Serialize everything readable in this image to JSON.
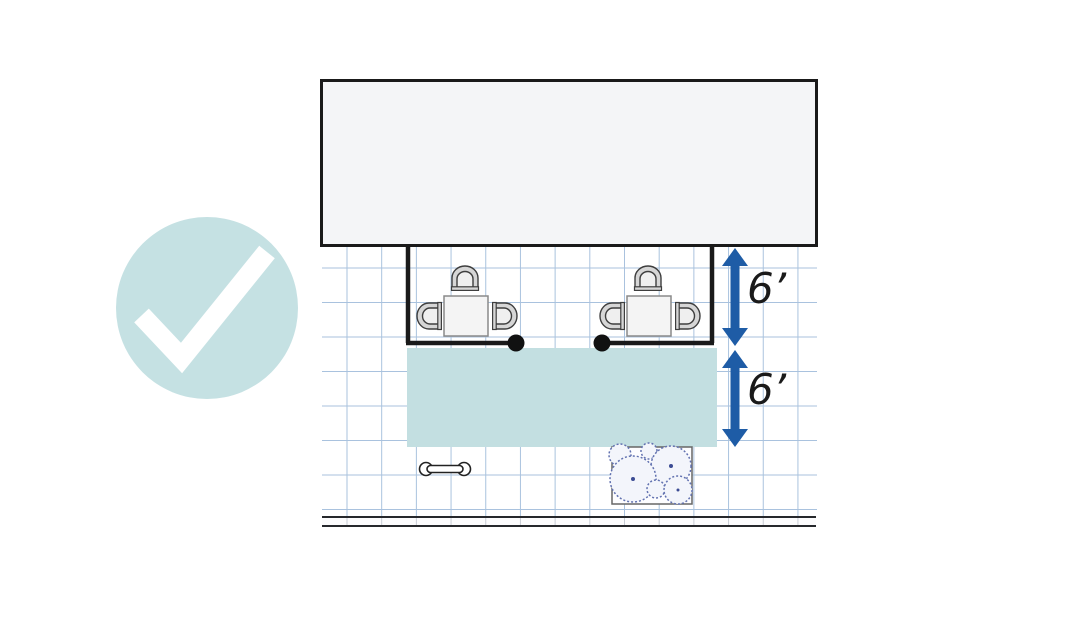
{
  "meta": {
    "description": "Plan-view diagram of a sidewalk cafe placed correctly against a building, marked with an approval checkmark"
  },
  "status_badge": {
    "icon": "checkmark-icon",
    "meaning": "correct-example"
  },
  "measurements": [
    {
      "id": "cafe-zone-depth",
      "label": "6’"
    },
    {
      "id": "clear-path-width",
      "label": "6’"
    }
  ],
  "scene": {
    "building": "building-footprint",
    "cafe_enclosure": "barrier-with-center-opening",
    "tables": 2,
    "chairs_per_table": 3,
    "clear_path": "pedestrian-clear-path",
    "street_furniture": [
      "bike-rack-icon",
      "tree-planter-icon"
    ],
    "street_edge": "curb-line"
  },
  "colors": {
    "teal_badge": "#c5e1e3",
    "teal_path": "#c3dfe1",
    "arrow_blue": "#1e5ca6",
    "grid_blue": "#a9c2de",
    "building_fill": "#f4f5f7",
    "line_black": "#1a1a1a",
    "chair_fill": "#d6d6d6",
    "chair_stroke": "#3e3e3e",
    "shrub_stroke": "#6272b0",
    "shrub_fill": "#f3f5fb"
  }
}
